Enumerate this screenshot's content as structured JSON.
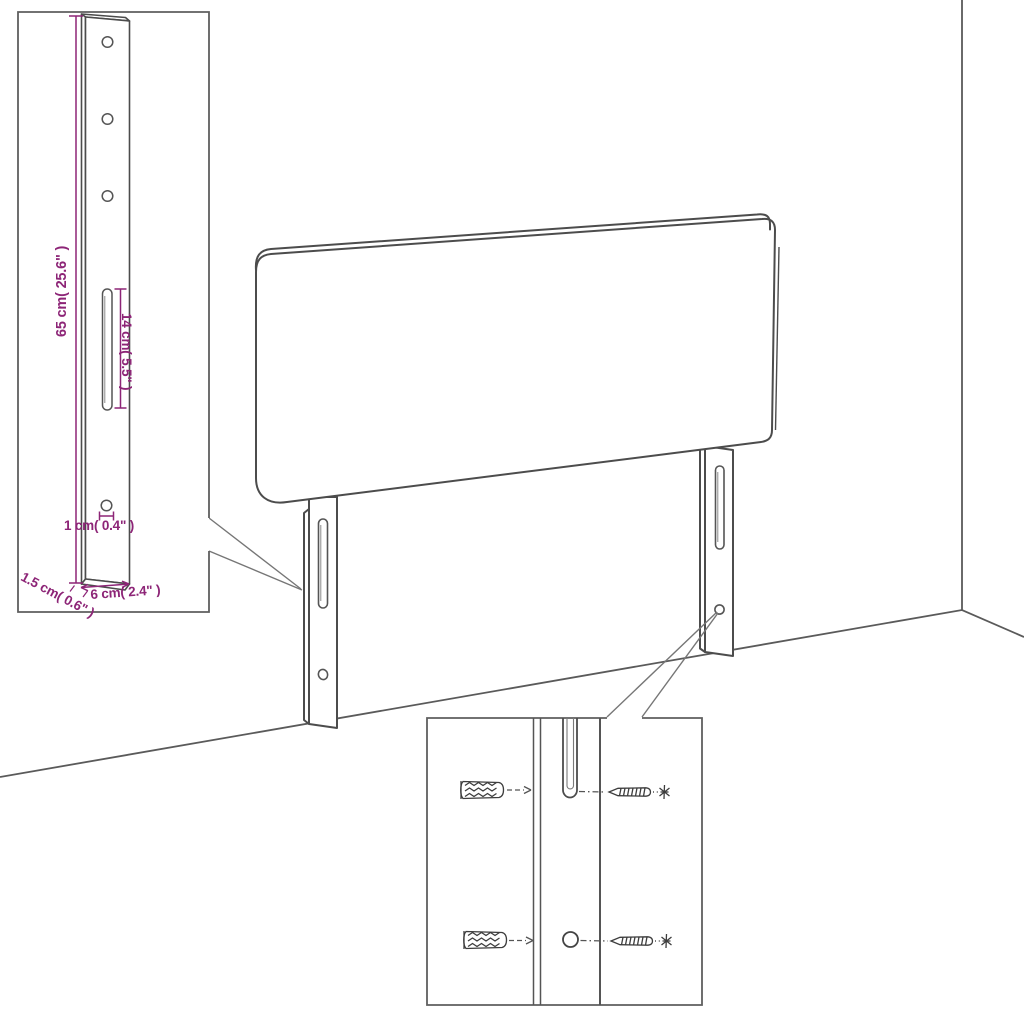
{
  "diagram": {
    "subject": "headboard wall-mounting assembly diagram",
    "background": "#ffffff",
    "colors": {
      "outline": "#4c4c4c",
      "detail": "#6e6e6e",
      "dimension": "#8d2577"
    },
    "dimensions": {
      "bracket_height": "65 cm( 25.6\" )",
      "slot_length": "14 cm( 5.5\" )",
      "hole_diameter": "1 cm( 0.4\" )",
      "bracket_thickness": "1.5 cm( 0.6\" )",
      "bracket_width": "6 cm( 2.4\" )"
    },
    "icons": {
      "wall_anchor": "ribbed-plug-shape",
      "screw": "pointed-screw-shape",
      "screw_head": "asterisk-shape"
    }
  }
}
